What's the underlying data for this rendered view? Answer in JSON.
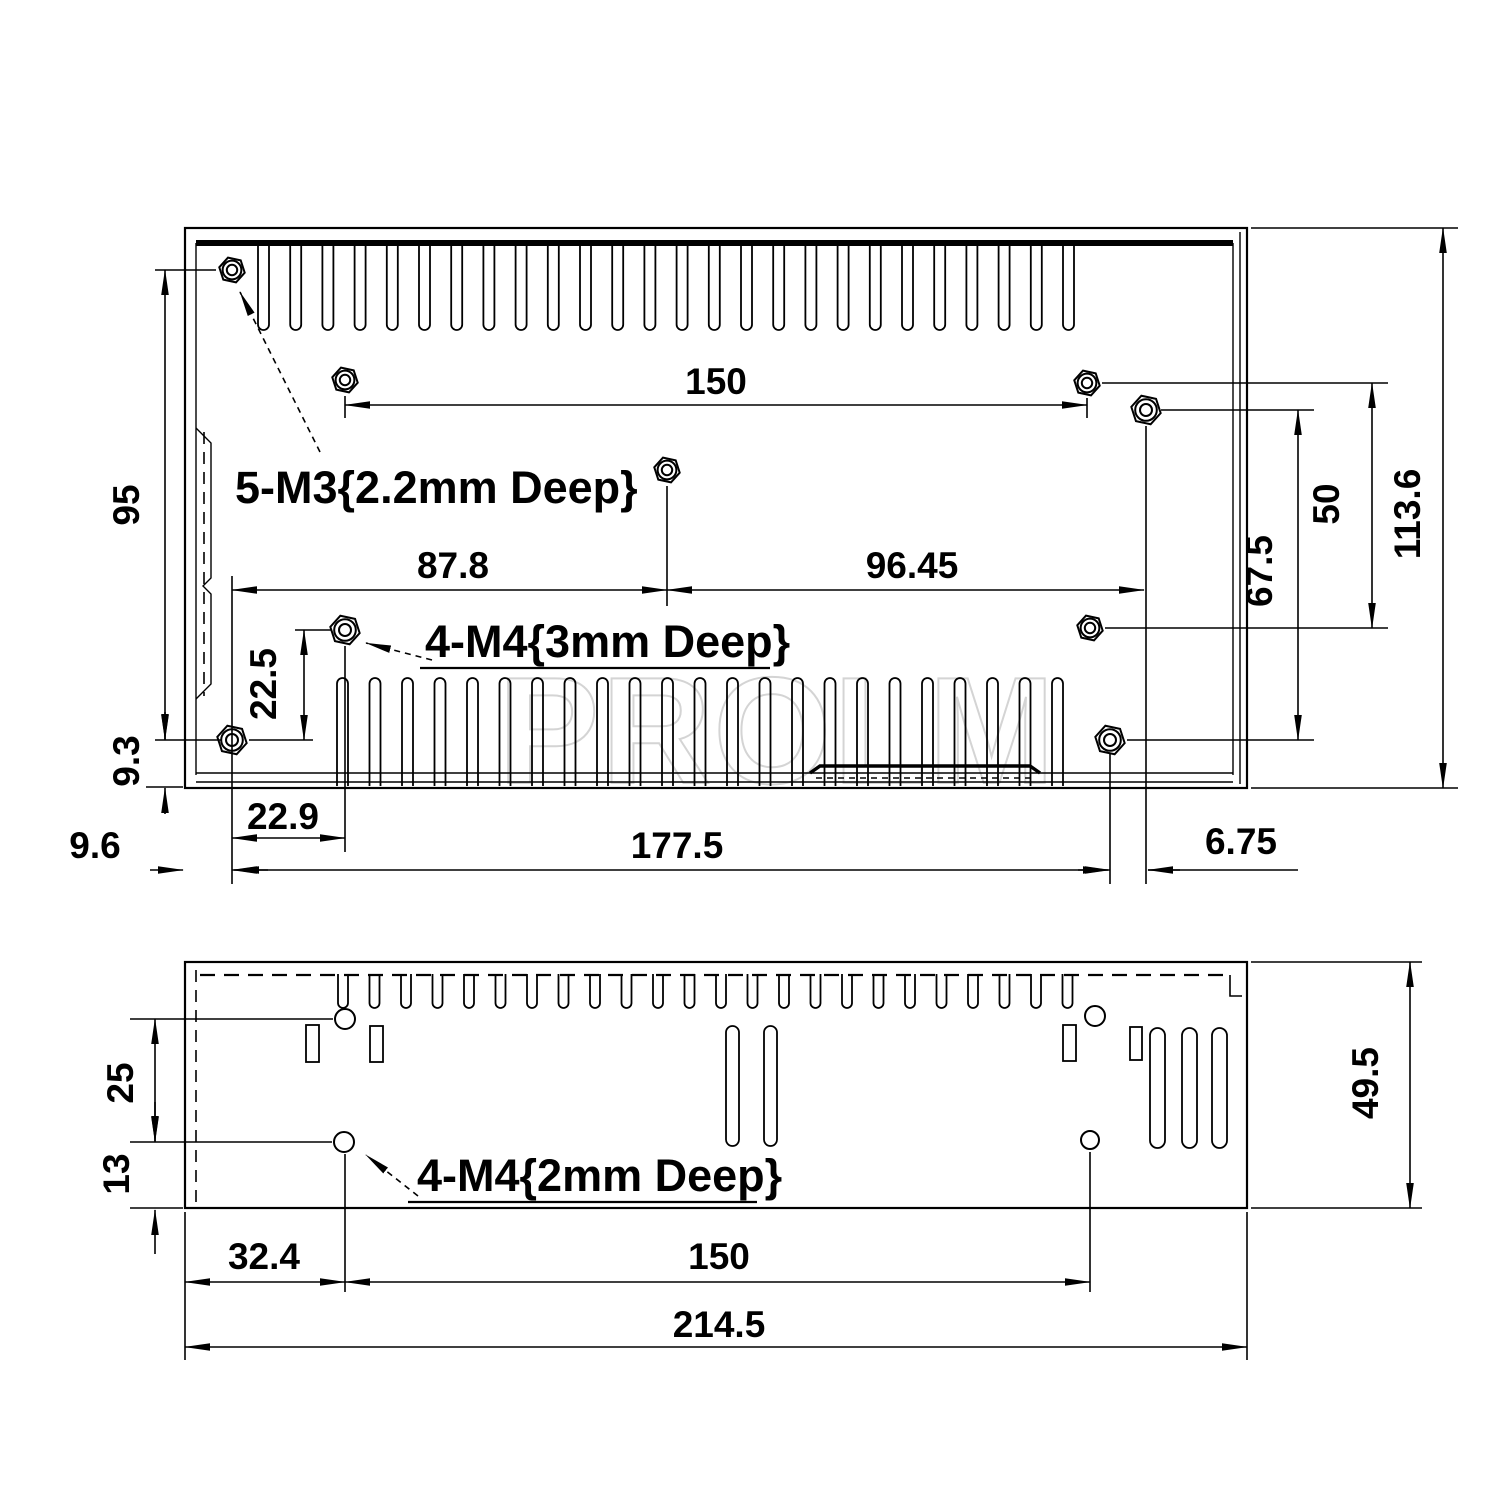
{
  "watermark": {
    "text": "PROLM"
  },
  "top_view": {
    "thread_labels": {
      "m3": "5-M3{2.2mm Deep}",
      "m4": "4-M4{3mm Deep}"
    },
    "dims": {
      "width_150": "150",
      "left_87_8": "87.8",
      "right_96_45": "96.45",
      "height_95": "95",
      "offset_9_3": "9.3",
      "offset_9_6": "9.6",
      "offset_22_9": "22.9",
      "offset_22_5": "22.5",
      "width_177_5": "177.5",
      "offset_6_75": "6.75",
      "right_50": "50",
      "right_67_5": "67.5",
      "height_113_6": "113.6"
    }
  },
  "side_view": {
    "thread_label": "4-M4{2mm Deep}",
    "dims": {
      "offset_25": "25",
      "offset_13": "13",
      "offset_32_4": "32.4",
      "width_150": "150",
      "width_214_5": "214.5",
      "height_49_5": "49.5"
    }
  }
}
